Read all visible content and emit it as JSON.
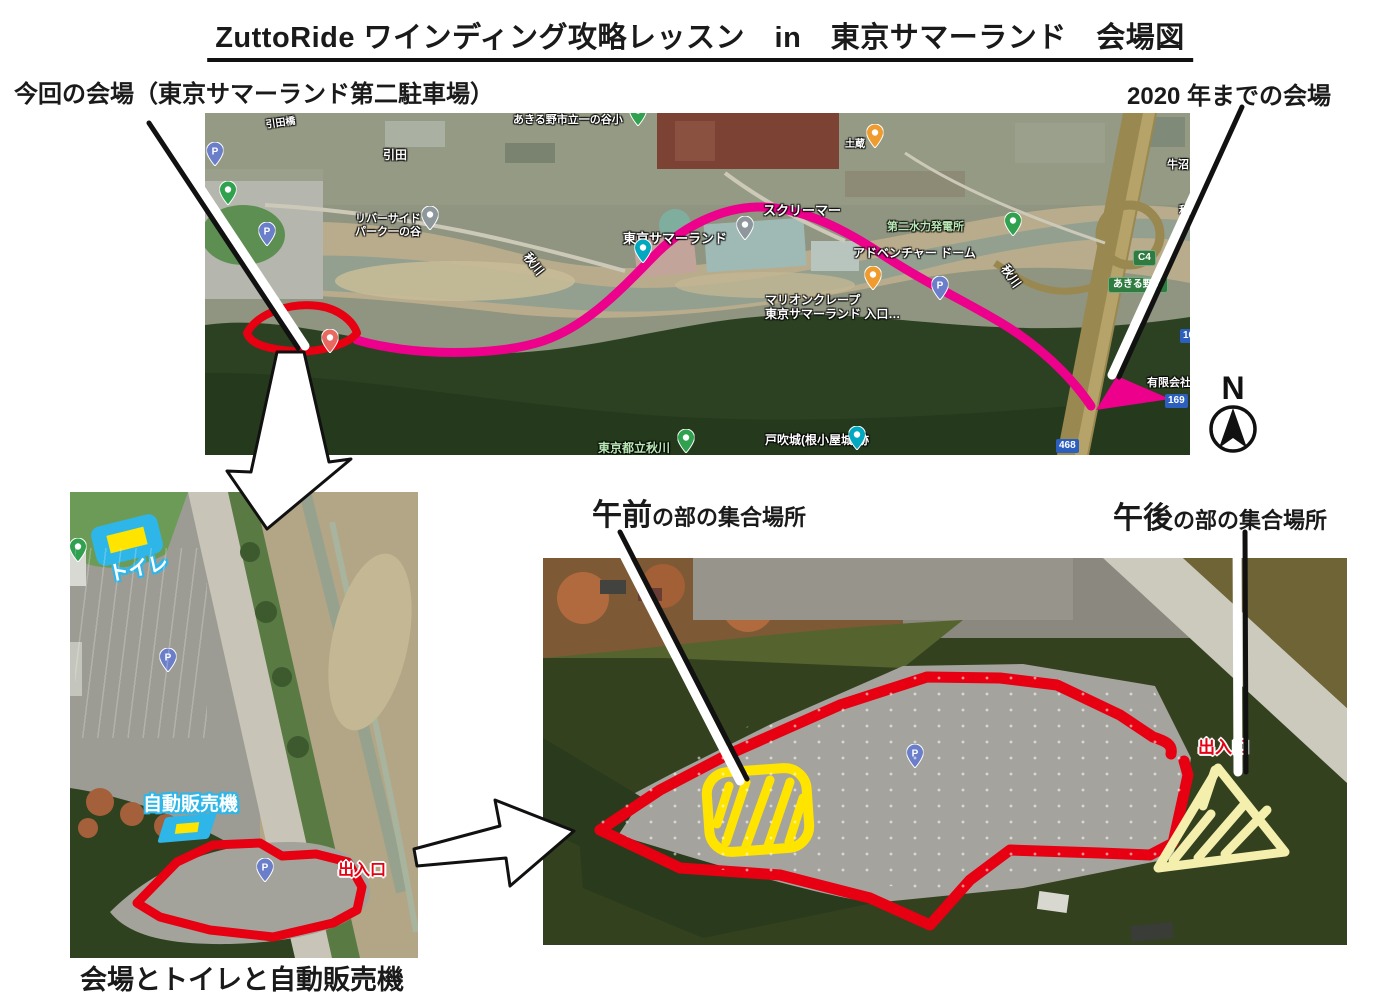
{
  "page": {
    "title": "ZuttoRide ワインディング攻略レッスン　in　東京サマーランド　会場図",
    "current_venue_label": "今回の会場（東京サマーランド第二駐車場）",
    "old_venue_label": "2020 年までの会場",
    "morning_label_strong": "午前",
    "morning_label_rest": "の部の集合場所",
    "afternoon_label_strong": "午後",
    "afternoon_label_rest": "の部の集合場所",
    "bottom_caption": "会場とトイレと自動販売機",
    "compass_letter": "N"
  },
  "colors": {
    "course_route": "#ec008c",
    "venue_outline": "#e60012",
    "morning_zone": "#ffe400",
    "afternoon_zone": "#f5efad",
    "facility_marker": "#2eb6e8",
    "pointer_line": "#111111"
  },
  "top_map": {
    "labels": [
      {
        "text": "あきる野市立一の谷小",
        "cls": "white",
        "x": 308,
        "y": 1,
        "size": 11
      },
      {
        "text": "引田橋",
        "cls": "white",
        "x": 60,
        "y": 7,
        "size": 10,
        "rot": -8
      },
      {
        "text": "引田",
        "cls": "white",
        "x": 178,
        "y": 36,
        "size": 12
      },
      {
        "text": "リバーサイド\nパーク一の谷",
        "cls": "white",
        "x": 150,
        "y": 100,
        "size": 11
      },
      {
        "text": "土蔵",
        "cls": "white",
        "x": 640,
        "y": 26,
        "size": 10
      },
      {
        "text": "牛沼",
        "cls": "white",
        "x": 962,
        "y": 46,
        "size": 11
      },
      {
        "text": "秋川",
        "cls": "white",
        "x": 974,
        "y": 92,
        "size": 11
      },
      {
        "text": "スクリーマー",
        "cls": "white",
        "x": 558,
        "y": 91,
        "size": 13
      },
      {
        "text": "東京サマーランド",
        "cls": "white",
        "x": 418,
        "y": 119,
        "size": 13
      },
      {
        "text": "第二水力発電所",
        "cls": "green",
        "x": 682,
        "y": 108,
        "size": 11
      },
      {
        "text": "アドベンチャー ドーム",
        "cls": "white",
        "x": 648,
        "y": 134,
        "size": 12
      },
      {
        "text": "マリオンクレープ\n東京サマーランド 入口…",
        "cls": "white",
        "x": 560,
        "y": 181,
        "size": 12
      },
      {
        "text": "秋川",
        "cls": "white",
        "x": 326,
        "y": 138,
        "size": 12,
        "rot": 52
      },
      {
        "text": "秋川",
        "cls": "white",
        "x": 804,
        "y": 150,
        "size": 12,
        "rot": 55
      },
      {
        "text": "有限会社",
        "cls": "white",
        "x": 942,
        "y": 264,
        "size": 11
      },
      {
        "text": "東京都立秋川",
        "cls": "green",
        "x": 393,
        "y": 329,
        "size": 12
      },
      {
        "text": "戸吹城(根小屋城)跡",
        "cls": "white",
        "x": 560,
        "y": 321,
        "size": 12
      },
      {
        "text": "C4",
        "cls": "badge-green",
        "x": 928,
        "y": 137,
        "size": 10
      },
      {
        "text": "あきる野IC",
        "cls": "badge-green",
        "x": 903,
        "y": 164,
        "size": 10
      },
      {
        "text": "169",
        "cls": "badge-blue",
        "x": 975,
        "y": 216,
        "size": 10
      },
      {
        "text": "169",
        "cls": "badge-blue",
        "x": 960,
        "y": 281,
        "size": 10
      },
      {
        "text": "468",
        "cls": "badge-blue",
        "x": 851,
        "y": 326,
        "size": 10
      }
    ],
    "pins": [
      {
        "kind": "parking",
        "x": 10,
        "y": 58
      },
      {
        "kind": "nature",
        "x": 23,
        "y": 97
      },
      {
        "kind": "parking",
        "x": 62,
        "y": 138
      },
      {
        "kind": "poi-gray",
        "x": 225,
        "y": 122
      },
      {
        "kind": "nature",
        "x": 433,
        "y": 18
      },
      {
        "kind": "poi-orange",
        "x": 670,
        "y": 40
      },
      {
        "kind": "attraction",
        "x": 438,
        "y": 155
      },
      {
        "kind": "poi-gray",
        "x": 540,
        "y": 132
      },
      {
        "kind": "food",
        "x": 668,
        "y": 182
      },
      {
        "kind": "parking",
        "x": 735,
        "y": 192
      },
      {
        "kind": "nature",
        "x": 808,
        "y": 128
      },
      {
        "kind": "poi-salmon",
        "x": 125,
        "y": 245
      },
      {
        "kind": "nature",
        "x": 481,
        "y": 345
      },
      {
        "kind": "attraction",
        "x": 652,
        "y": 342
      }
    ]
  },
  "left_map": {
    "toilet_label": "トイレ",
    "vending_label": "自動販売機",
    "labels": [
      {
        "text": "出入口",
        "cls": "red-exit",
        "x": 268,
        "y": 370,
        "size": 16
      }
    ],
    "pins": [
      {
        "kind": "nature",
        "x": 8,
        "y": 75
      },
      {
        "kind": "parking",
        "x": 98,
        "y": 185
      },
      {
        "kind": "parking",
        "x": 195,
        "y": 395
      }
    ]
  },
  "right_map": {
    "labels": [
      {
        "text": "出入口",
        "cls": "red-exit",
        "x": 655,
        "y": 180,
        "size": 17
      }
    ],
    "pins": [
      {
        "kind": "parking",
        "x": 372,
        "y": 215
      }
    ]
  }
}
